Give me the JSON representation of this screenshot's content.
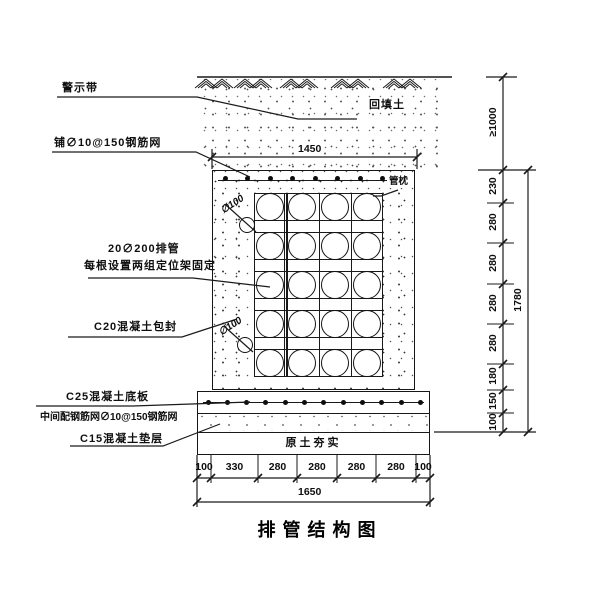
{
  "title": "排管结构图",
  "labels": {
    "warning_tape": "警示带",
    "top_mesh": "铺∅10@150钢筋网",
    "pipe_row_1": "20∅200排管",
    "pipe_row_2": "每根设置两组定位架固定",
    "encasement": "C20混凝土包封",
    "base_slab": "C25混凝土底板",
    "slab_mesh": "中间配钢筋网∅10@150钢筋网",
    "cushion": "C15混凝土垫层",
    "backfill": "回填土",
    "pipe_cradle": "管枕",
    "compacted_soil": "原土夯实",
    "drain_top": "∅100",
    "drain_bottom": "∅100"
  },
  "dims": {
    "top_width": "1450",
    "bottom_total": "1650",
    "right_total": "1780",
    "cover": "≥1000",
    "right_segments": [
      "230",
      "280",
      "280",
      "280",
      "280",
      "180",
      "150",
      "100"
    ],
    "bottom_segments": [
      "100",
      "330",
      "280",
      "280",
      "280",
      "280",
      "100"
    ]
  },
  "pipes": {
    "rows": 5,
    "cols": 4
  }
}
